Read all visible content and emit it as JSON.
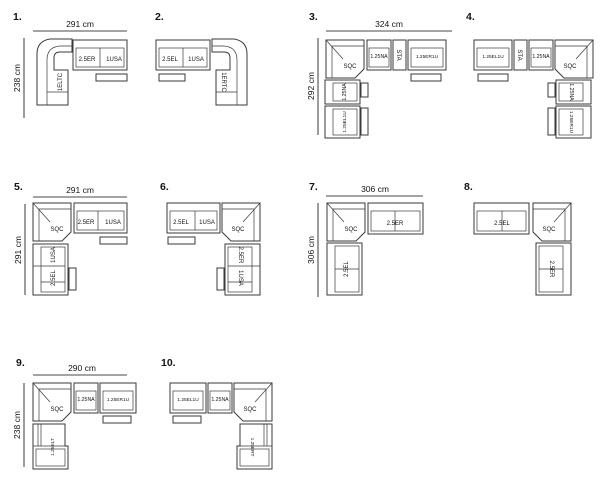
{
  "colors": {
    "background": "#ffffff",
    "line": "#3a3a3a",
    "text": "#141414"
  },
  "configs": [
    {
      "number": "1.",
      "dims": {
        "width": "291 cm",
        "height": "238 cm"
      },
      "labels": {
        "corner": "1ELTC",
        "a": "2.5ER",
        "b": "1USA"
      }
    },
    {
      "number": "2.",
      "dims": {},
      "labels": {
        "a": "2.5EL",
        "b": "1USA",
        "corner": "1ERTC"
      }
    },
    {
      "number": "3.",
      "dims": {
        "width": "324 cm",
        "height": "292 cm"
      },
      "labels": {
        "corner": "SQC",
        "a": "1.25NA",
        "b": "STA",
        "c": "1.25ER1U",
        "d": "1.25NA",
        "e": "1.25EL1U"
      }
    },
    {
      "number": "4.",
      "dims": {},
      "labels": {
        "a": "1.25EL1U",
        "b": "STA",
        "c": "1.25NA",
        "corner": "SQC",
        "d": "1.25NA",
        "e": "1.25ER1U"
      }
    },
    {
      "number": "5.",
      "dims": {
        "width": "291 cm",
        "height": "291 cm"
      },
      "labels": {
        "corner": "SQC",
        "a": "2.5ER",
        "b": "1USA",
        "c": "1USA",
        "d": "2.5EL"
      }
    },
    {
      "number": "6.",
      "dims": {},
      "labels": {
        "a": "2.5EL",
        "b": "1USA",
        "corner": "SQC",
        "c": "2.5ER",
        "d": "1USA"
      }
    },
    {
      "number": "7.",
      "dims": {
        "width": "306 cm",
        "height": "306 cm"
      },
      "labels": {
        "corner": "SQC",
        "a": "2.5ER",
        "b": "2.5EL"
      }
    },
    {
      "number": "8.",
      "dims": {},
      "labels": {
        "a": "2.5EL",
        "corner": "SQC",
        "b": "2.5ER"
      }
    },
    {
      "number": "9.",
      "dims": {
        "width": "290 cm",
        "height": "238 cm"
      },
      "labels": {
        "corner": "SQC",
        "a": "1.25NA",
        "b": "1.25ER1U",
        "c": "1.25ELT"
      }
    },
    {
      "number": "10.",
      "dims": {},
      "labels": {
        "a": "1.25EL1U",
        "b": "1.25NA",
        "corner": "SQC",
        "c": "1.25ERT"
      }
    }
  ]
}
